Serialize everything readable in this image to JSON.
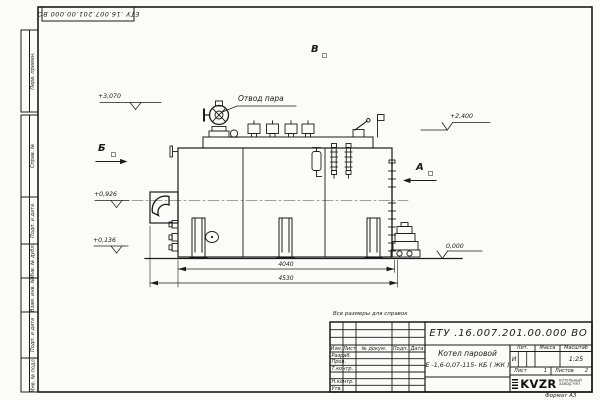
{
  "ink": "#1b1b1b",
  "sheet": {
    "format_label": "Формат А3",
    "reference_note": "Все размеры для справок",
    "margin_labels": [
      "Перв. примен.",
      "Справ. №",
      "Подп. и дата",
      "Инв. № дубл.",
      "Взам. инв. №",
      "Подп. и дата",
      "Инв. № подл."
    ]
  },
  "title_block": {
    "designation": "ЕТУ .16.007.201.00.000  ВО",
    "product_name_line1": "Котел паровой",
    "product_name_line2": "Е -1,6-0,07-115- КБ ( ЖК )",
    "columns": [
      "Изм.",
      "Лист",
      "№ докум.",
      "Подп.",
      "Дата"
    ],
    "rows": [
      "Разраб.",
      "Пров.",
      "Т.контр.",
      "",
      "Н.контр.",
      "Утв."
    ],
    "lit_label": "Лит.",
    "lit_value": "И",
    "mass_label": "Масса",
    "mass_value": "",
    "scale_label": "Масштаб",
    "scale_value": "1:25",
    "sheet_label": "Лист",
    "sheet_number": "1",
    "sheets_label": "Листов",
    "sheets_total": "2",
    "company": {
      "logo": "KVZR",
      "line1": "КОТЕЛЬНЫЙ",
      "line2": "ЗАВОД РЭП"
    }
  },
  "drawing": {
    "steam_outlet_label": "Отвод пара",
    "view_labels": {
      "a": "А",
      "b": "Б",
      "v": "В"
    },
    "elevations": {
      "top": "+3,070",
      "right": "+2,400",
      "mid": "+0,926",
      "low": "+0,136",
      "zero": "0,000"
    },
    "dimensions": {
      "inner": "4040",
      "overall": "4530"
    }
  }
}
